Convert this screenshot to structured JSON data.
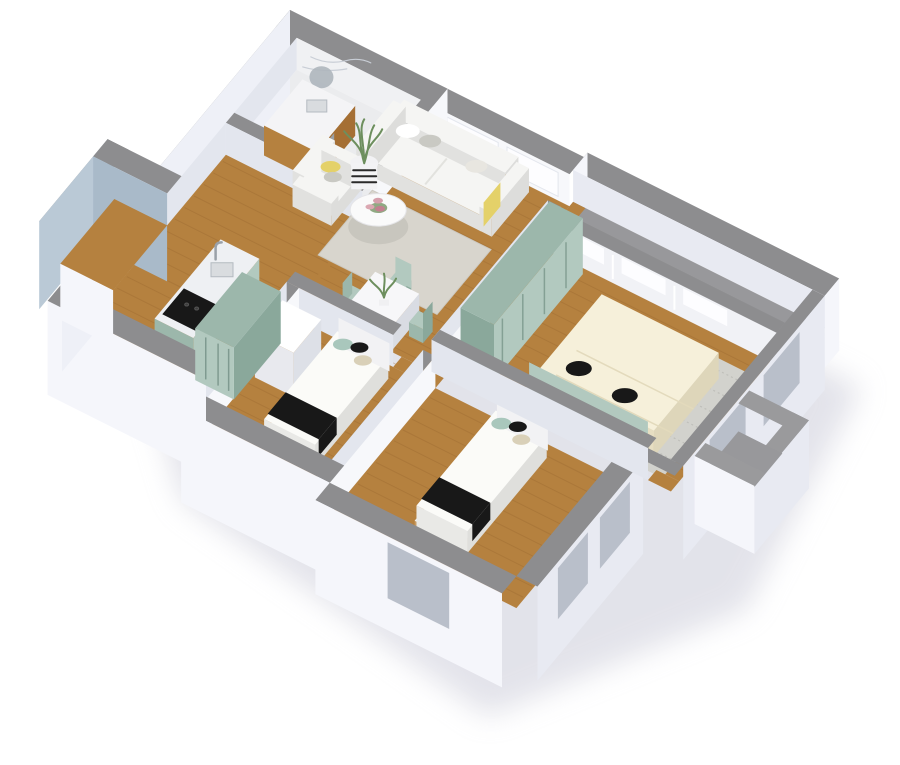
{
  "render": {
    "style": "isometric-3d-floor-plan",
    "background": "#ffffff"
  },
  "rooms": [
    "bathroom",
    "entry-hall",
    "living-room",
    "kitchen-dining",
    "master-bedroom",
    "kids-bedroom-1",
    "kids-bedroom-2",
    "balcony",
    "entry-porch"
  ],
  "furniture": [
    "sofa",
    "armchair",
    "coffee-table",
    "living-rug",
    "potted-plant",
    "dining-table",
    "dining-chairs",
    "kitchen-counter-with-sink",
    "stove",
    "bathroom-vanity",
    "round-mirror",
    "hall-wardrobe",
    "dresser",
    "bedroom-wardrobe",
    "double-bed",
    "bedroom-rug",
    "single-bed",
    "single-bed-2"
  ],
  "colors": {
    "wallTop": "#8d8d8f",
    "wallTopLight": "#9a9a9c",
    "extFace": "#f5f6fb",
    "extFaceShade": "#e8eaf2",
    "extFaceW": "#eef0f7",
    "innerLit": "#f7f8fb",
    "innerDim": "#e3e6ee",
    "panelFace": "#f1f2f6",
    "marble": "#ebecee",
    "marbleFace": "#f0f1f3",
    "vein": "#c9ced6",
    "blue": "#a9bac9",
    "blueLight": "#bac9d6",
    "wood": "#b5813f",
    "woodDark": "#a56f34",
    "woodLine": "#93622c",
    "woodBase": "#c69a62",
    "balcony": "#98989b",
    "mint": "#b2c9bf",
    "mintDark": "#9cb7ab",
    "mintDeep": "#8aa89b",
    "white": "#f5f5f3",
    "whiteShade": "#e1e1df",
    "cream": "#f6f0da",
    "creamShade": "#e6dec2",
    "black": "#181818",
    "rugLiving": "#d8d5cd",
    "rugBed": "#d2d2cd",
    "yellow": "#e4d169",
    "beige": "#d9d0b8",
    "mintPillow": "#a9c7bc",
    "grayPillow": "#c9c9c3",
    "pink": "#d59fab",
    "pinkDark": "#c2808f",
    "green": "#6d8f5e",
    "steel": "#d9dcdf",
    "winDark": "#b9bfca",
    "shadow": "#c7c8d6"
  }
}
